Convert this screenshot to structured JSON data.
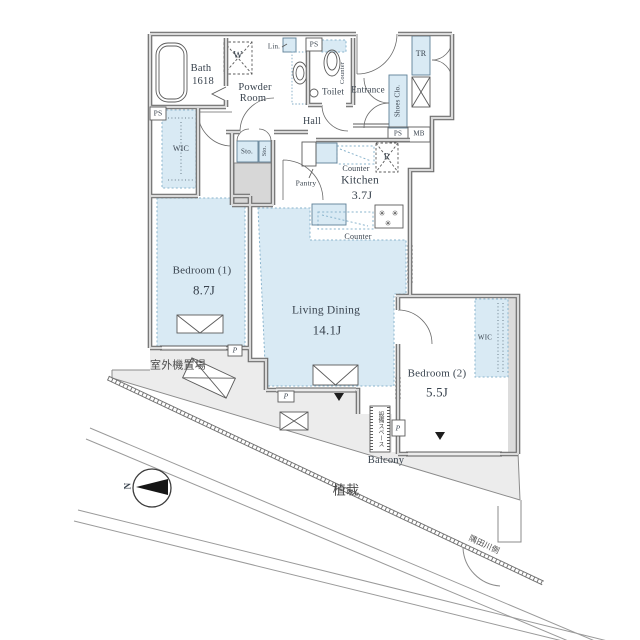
{
  "colors": {
    "room_fill": "#d9eaf4",
    "wall_dark": "#6e6e6e",
    "wall_light": "#dadada",
    "dotted_border": "#8ab4cd",
    "text": "#39434e"
  },
  "rooms": {
    "bath": {
      "name": "Bath",
      "size": "1618"
    },
    "powder_room": {
      "line1": "Powder",
      "line2": "Room"
    },
    "toilet": {
      "name": "Toilet"
    },
    "hall": {
      "name": "Hall"
    },
    "entrance": {
      "name": "Entrance"
    },
    "kitchen": {
      "name": "Kitchen",
      "area": "3.7J"
    },
    "bedroom1": {
      "name": "Bedroom (1)",
      "area": "8.7J"
    },
    "living_dining": {
      "name": "Living Dining",
      "area": "14.1J"
    },
    "bedroom2": {
      "name": "Bedroom (2)",
      "area": "5.5J"
    },
    "balcony": {
      "name": "Balcony"
    }
  },
  "storage": {
    "wic": "WIC",
    "shoes_closet": "Shoes Clo.",
    "trunk_room": "TR",
    "storage_abbr": "Sto.",
    "linen": "Lin.",
    "pantry": "Pantry",
    "washer": "W",
    "refrigerator": "R"
  },
  "fixtures": {
    "counter": "Counter"
  },
  "shafts": {
    "pipe_space": "PS",
    "meter_box": "MB",
    "pipe": "P"
  },
  "site": {
    "north": "N",
    "planting": "植栽",
    "outdoor_unit_area": "室外機置場",
    "equipment_space": "設備スペース",
    "river_side": "隅田川側"
  }
}
